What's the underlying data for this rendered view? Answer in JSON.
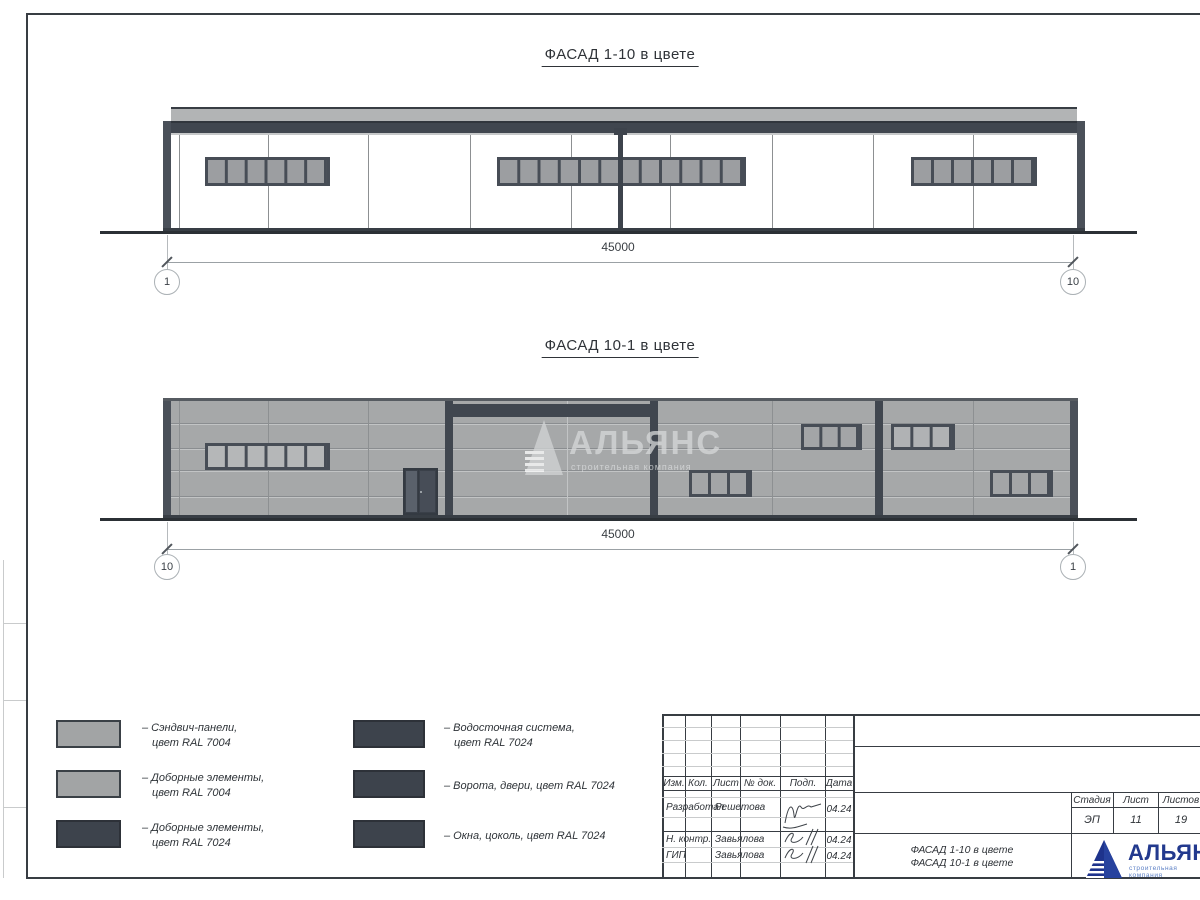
{
  "facades": {
    "f1": {
      "title": "ФАСАД 1-10 в цвете",
      "dim": "45000",
      "axis_left": "1",
      "axis_right": "10"
    },
    "f2": {
      "title": "ФАСАД 10-1 в цвете",
      "dim": "45000",
      "axis_left": "10",
      "axis_right": "1"
    }
  },
  "watermark": {
    "name": "АЛЬЯНС",
    "subtitle": "строительная компания"
  },
  "legend": [
    {
      "line1": "– Сэндвич-панели,",
      "line2": "цвет RAL 7004"
    },
    {
      "line1": "– Доборные элементы,",
      "line2": "цвет RAL 7004"
    },
    {
      "line1": "– Доборные элементы,",
      "line2": "цвет RAL 7024"
    },
    {
      "line1": "– Водосточная система,",
      "line2": "цвет RAL 7024"
    },
    {
      "line1": "– Ворота, двери, цвет RAL 7024",
      "line2": ""
    },
    {
      "line1": "– Окна, цоколь, цвет RAL 7024",
      "line2": ""
    }
  ],
  "titleblock": {
    "cols": {
      "izm": "Изм.",
      "kol": "Кол.",
      "list": "Лист",
      "doc": "№ док.",
      "podp": "Подп.",
      "data": "Дата"
    },
    "rows": [
      {
        "role": "Разработал",
        "name": "Решетова",
        "date": "04.24"
      },
      {
        "role": "Н. контр.",
        "name": "Завьялова",
        "date": "04.24"
      },
      {
        "role": "ГИП",
        "name": "Завьялова",
        "date": "04.24"
      }
    ],
    "stamp": {
      "stage_label": "Стадия",
      "sheet_label": "Лист",
      "sheets_label": "Листов",
      "stage": "ЭП",
      "sheet": "11",
      "sheets": "19"
    },
    "doc_line1": "ФАСАД 1-10 в цвете",
    "doc_line2": "ФАСАД 10-1 в цвете"
  },
  "logo": {
    "name": "АЛЬЯНС",
    "subtitle": "строительная компания"
  },
  "colors": {
    "ral7004": "#a6a8a9",
    "ral7024": "#40464f",
    "logo_blue": "#22398e",
    "logo_light_blue": "#5b7fc5"
  }
}
